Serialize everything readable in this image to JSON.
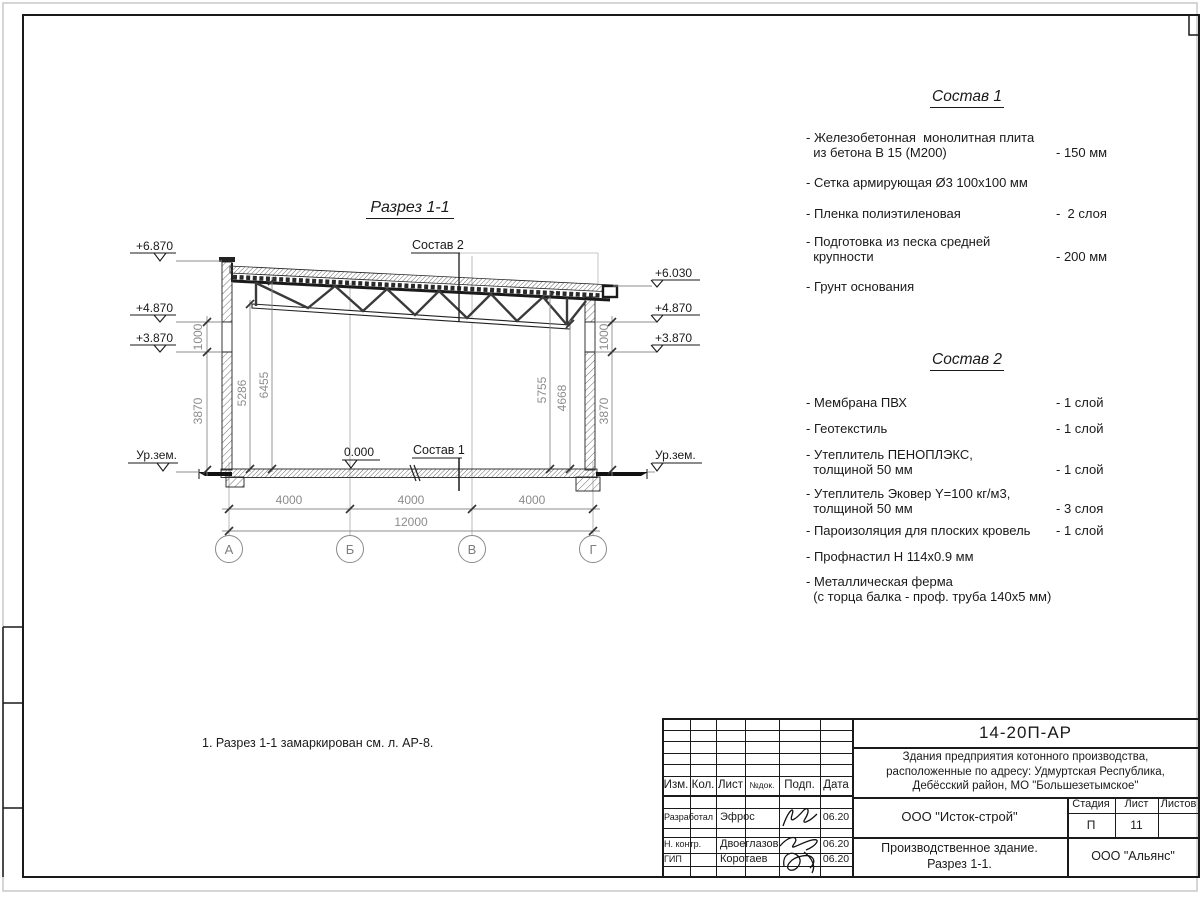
{
  "page": {
    "drawing_title": "Разрез 1-1",
    "note": "1. Разрез 1-1 замаркирован см. л. АР-8."
  },
  "sostav1": {
    "heading": "Состав 1",
    "items": [
      {
        "name": "- Железобетонная  монолитная плита\n  из бетона В 15 (М200)",
        "value": "- 150 мм"
      },
      {
        "name": "- Сетка армирующая Ø3 100х100 мм",
        "value": ""
      },
      {
        "name": "- Пленка полиэтиленовая",
        "value": "-  2 слоя"
      },
      {
        "name": "- Подготовка из песка средней\n  крупности",
        "value": "- 200 мм"
      },
      {
        "name": "- Грунт основания",
        "value": ""
      }
    ]
  },
  "sostav2": {
    "heading": "Состав 2",
    "items": [
      {
        "name": "- Мембрана ПВХ",
        "value": "- 1 слой"
      },
      {
        "name": "- Геотекстиль",
        "value": "- 1 слой"
      },
      {
        "name": "- Утеплитель ПЕНОПЛЭКС,\n  толщиной 50 мм",
        "value": "- 1 слой"
      },
      {
        "name": "- Утеплитель Эковер Y=100 кг/м3,\n  толщиной 50 мм",
        "value": "- 3 слоя"
      },
      {
        "name": "- Пароизоляция для плоских кровель",
        "value": "- 1 слой"
      },
      {
        "name": "- Профнастил Н 114х0.9 мм",
        "value": ""
      },
      {
        "name": "- Металлическая ферма\n  (с торца балка - проф. труба 140х5 мм)",
        "value": ""
      }
    ]
  },
  "section": {
    "label_sostav2": "Состав 2",
    "label_sostav1": "Состав 1",
    "zero_mark": "0.000",
    "ground_left": "Ур.зем.",
    "ground_right": "Ур.зем.",
    "elev_left": {
      "top": "+6.870",
      "mid": "+4.870",
      "low": "+3.870"
    },
    "elev_right": {
      "top": "+6.030",
      "mid": "+4.870",
      "low": "+3.870"
    },
    "dims": {
      "bay1": "4000",
      "bay2": "4000",
      "bay3": "4000",
      "total": "12000",
      "left_win": "1000",
      "left_wall": "3870",
      "right_win": "1000",
      "right_wall": "3870",
      "h_left1": "5286",
      "h_left2": "6455",
      "h_right1": "5755",
      "h_right2": "4668"
    },
    "axes": {
      "a": "А",
      "b": "Б",
      "v": "В",
      "g": "Г"
    }
  },
  "title_block": {
    "doc_number": "14-20П-АР",
    "project_description": "Здания предприятия котонного производства,\nрасположенные по адресу: Удмуртская Республика,\nДебёсский район, МО \"Большезетымское\"",
    "columns": {
      "izm": "Изм.",
      "kol": "Кол.",
      "list": "Лист",
      "ndok": "№док.",
      "podp": "Подп.",
      "data": "Дата"
    },
    "rows": [
      {
        "role": "Разработал",
        "name": "Эфрос",
        "date": "06.20"
      },
      {
        "role": "Н. контр.",
        "name": "Двоеглазов",
        "date": "06.20"
      },
      {
        "role": "ГИП",
        "name": "Коротаев",
        "date": "06.20"
      }
    ],
    "organization": "ООО \"Исток-строй\"",
    "stage_label": "Стадия",
    "sheet_label": "Лист",
    "sheets_label": "Листов",
    "stage": "П",
    "sheet": "11",
    "sheets": "",
    "object_title": "Производственное здание.\nРазрез 1-1.",
    "contractor": "ООО \"Альянс\""
  }
}
